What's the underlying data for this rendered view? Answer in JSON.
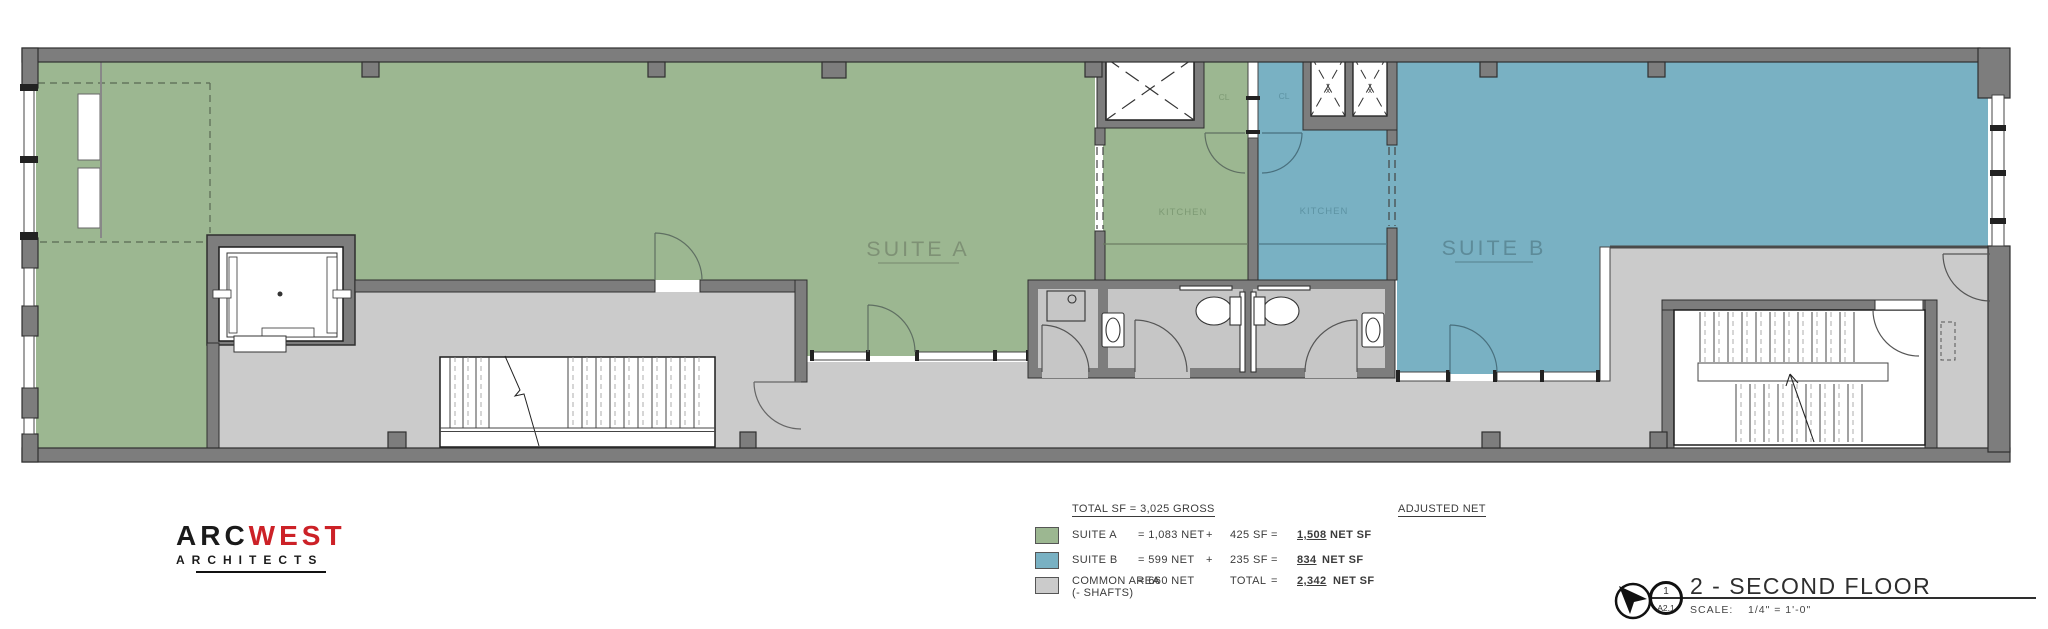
{
  "plan": {
    "suite_a_label": "SUITE A",
    "suite_b_label": "SUITE B",
    "kitchen_a_label": "KITCHEN",
    "kitchen_b_label": "KITCHEN",
    "closet_a_label": "CL",
    "closet_b_label": "CL",
    "shaft_a_mark": "x",
    "shaft_b_mark": "x"
  },
  "legend": {
    "total_header": "TOTAL SF = 3,025 GROSS",
    "adjusted_header": "ADJUSTED NET",
    "rows": [
      {
        "label": "SUITE A",
        "label2": "",
        "net": "= 1,083 NET",
        "plus": "+",
        "add": "425 SF",
        "eq": "=",
        "result": "1,508",
        "result_suffix": " NET SF"
      },
      {
        "label": "SUITE B",
        "label2": "",
        "net": "= 599 NET",
        "plus": "+",
        "add": "235 SF",
        "eq": "=",
        "result": "834",
        "result_suffix": " NET SF"
      },
      {
        "label": "COMMON AREA",
        "label2": "(- SHAFTS)",
        "net": "= 660 NET",
        "plus": "",
        "add": "TOTAL",
        "eq": "=",
        "result": "2,342",
        "result_suffix": " NET SF"
      }
    ]
  },
  "logo": {
    "part1": "ARC",
    "part2": "WEST",
    "subtitle": "ARCHITECTS"
  },
  "titleblock": {
    "detail_number": "1",
    "sheet_number": "A2.1",
    "title": "2 - SECOND FLOOR",
    "scale_label": "SCALE:",
    "scale_value": "1/4\" = 1'-0\""
  },
  "colors": {
    "suite_a": "#9cb791",
    "suite_b": "#79b1c3",
    "common": "#cbcbcb",
    "wall": "#7d7d7d",
    "logo_red": "#cc2127"
  }
}
